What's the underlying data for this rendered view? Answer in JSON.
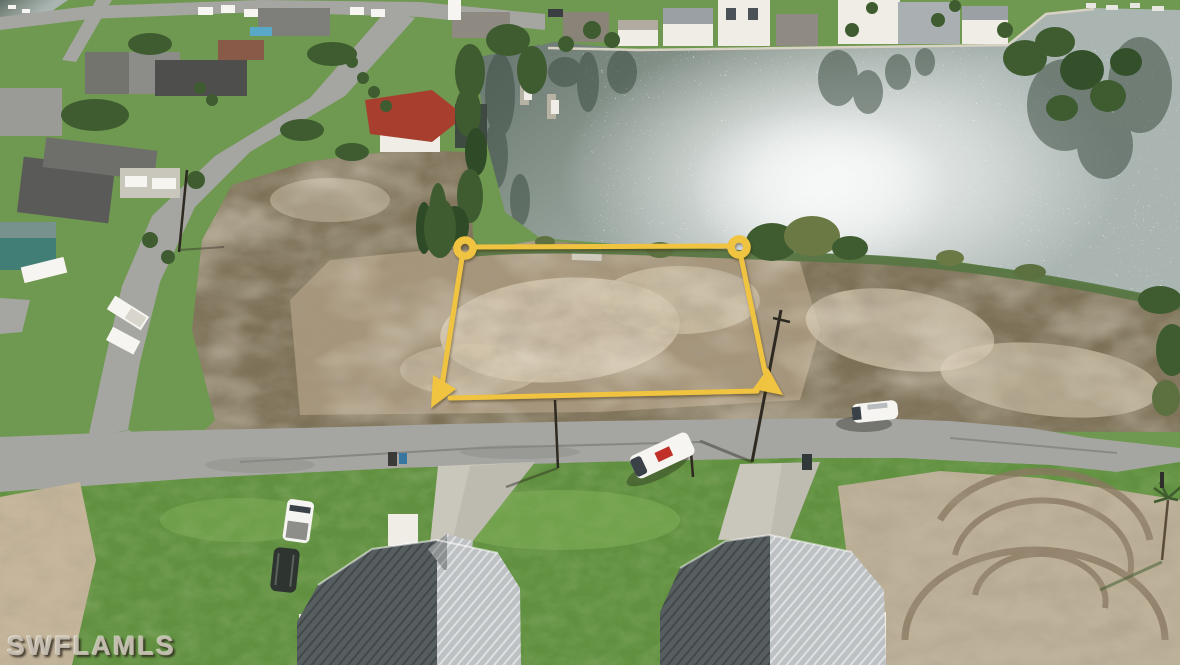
{
  "watermark": {
    "text": "SWFLAMLS"
  },
  "overlay": {
    "type": "property-boundary-outline",
    "shape": "quadrilateral",
    "markers": [
      "circle-top-left",
      "circle-top-right",
      "arrow-bottom-left",
      "arrow-bottom-right"
    ]
  },
  "colors": {
    "boundaryYellow": "#F0C441",
    "waterDark": "#5f6f67",
    "waterMid": "#8a978f",
    "waterLight": "#aab5b2",
    "glint": "#f7f9f8",
    "grassNeighborhood": "#6f9850",
    "grassBright": "#619140",
    "grassLight": "#7fae57",
    "shoreGreen": "#567543",
    "lotBase": "#a5957a",
    "lotSand": "#d2c6ae",
    "lotDark": "#6f5f4a",
    "scrubRight": "#7d7258",
    "road": "#a5a5a1",
    "roadDark": "#8c8c88",
    "concrete": "#c9c6bb",
    "dirtPatch": "#bfb29a",
    "dirtTrack": "#8a7962",
    "sandLeft": "#c6b79c",
    "treeGreen": "#3e5c30",
    "roofDark": "#565e60",
    "roofLight": "#bdc1c3",
    "redRoof": "#a83e2e",
    "tealHouse": "#417e76",
    "whiteStruct": "#efede6",
    "vehicleWhite": "#f6f5f1",
    "vehicleDark": "#2e3430",
    "poleDark": "#2e2a22"
  }
}
